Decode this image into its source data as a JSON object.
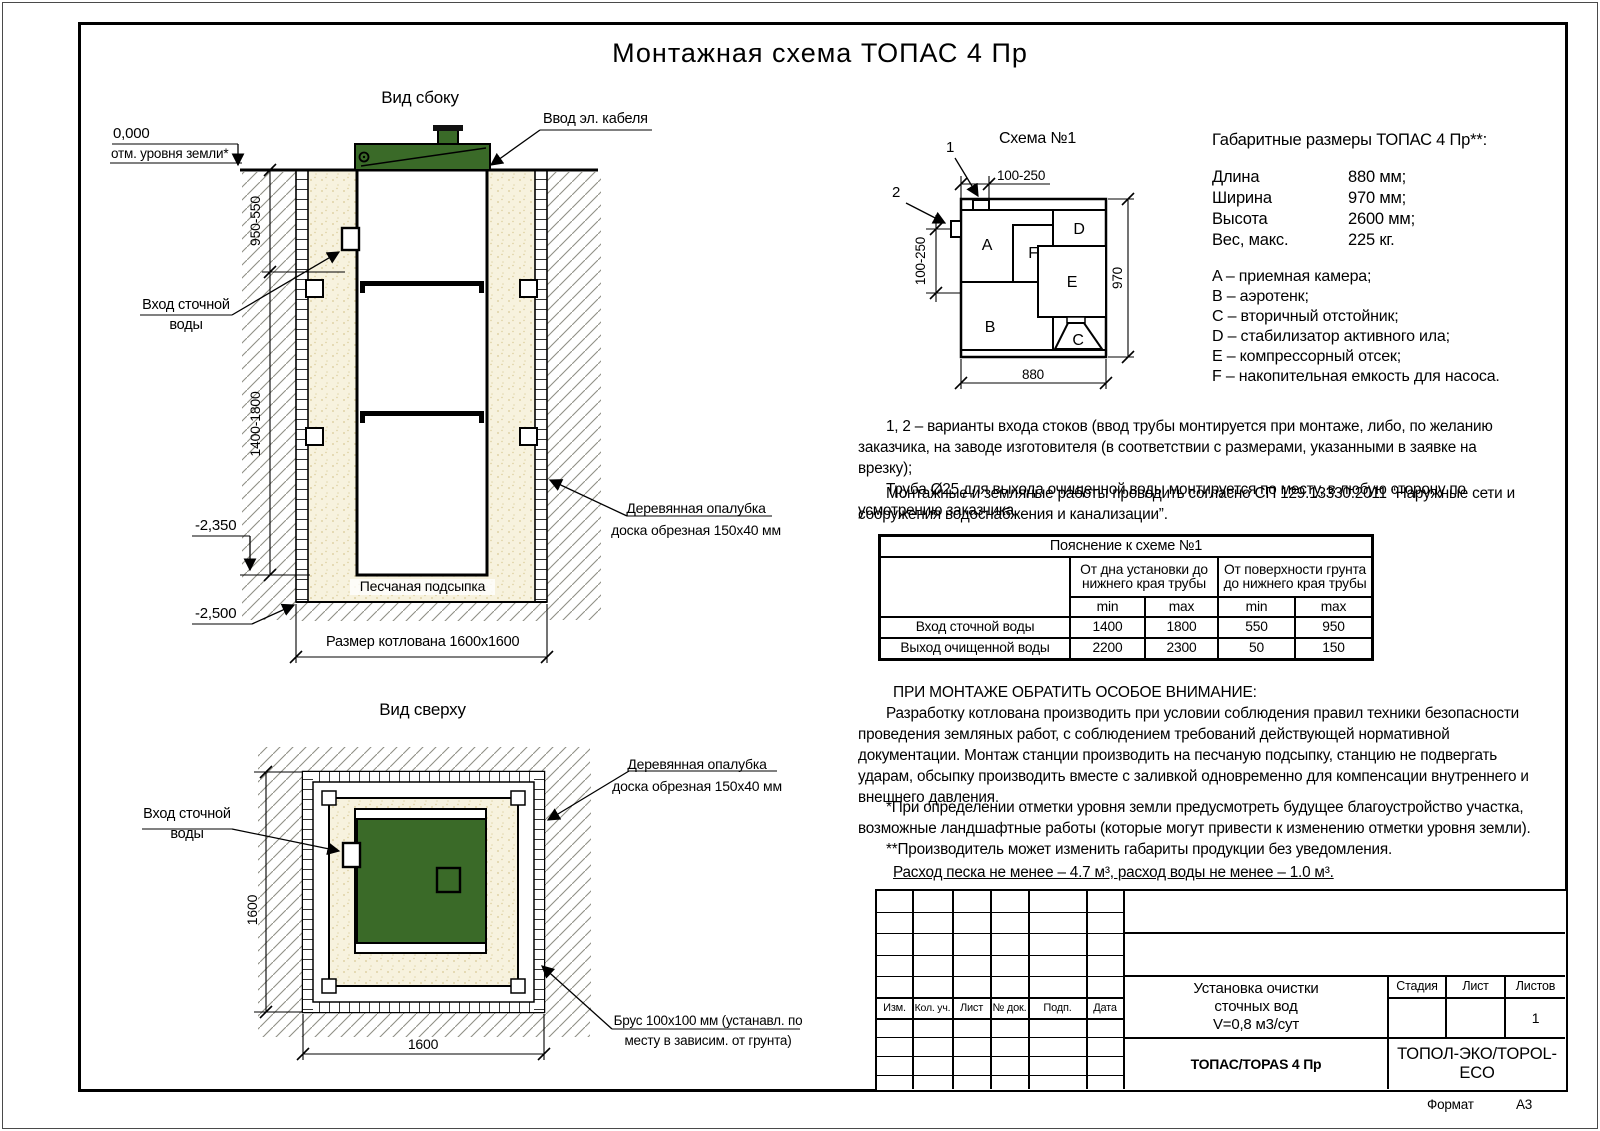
{
  "page": {
    "title": "Монтажная схема ТОПАС 4 Пр",
    "format_label": "Формат",
    "format_value": "А3"
  },
  "colors": {
    "lid_green": "#3a6a28",
    "sand": "#f7f2de",
    "line": "#000000",
    "hatch": "#8f8f85"
  },
  "side_view": {
    "title": "Вид сбоку",
    "cable_label": "Ввод эл. кабеля",
    "zero_mark": "0,000",
    "ground_mark": "отм. уровня земли*",
    "inlet_line1": "Вход сточной",
    "inlet_line2": "воды",
    "dim_upper": "950-550",
    "dim_lower": "1400-1800",
    "level1": "-2,350",
    "level2": "-2,500",
    "sand_label": "Песчаная подсыпка",
    "pit_dim": "Размер котлована 1600x1600",
    "formwork_line1": "Деревянная опалубка",
    "formwork_line2": "доска обрезная 150x40 мм"
  },
  "top_view": {
    "title": "Вид сверху",
    "inlet_line1": "Вход сточной",
    "inlet_line2": "воды",
    "formwork_line1": "Деревянная опалубка",
    "formwork_line2": "доска обрезная 150x40 мм",
    "dim_vertical": "1600",
    "dim_horizontal": "1600",
    "timber_line1": "Брус 100x100 мм (устанавл. по",
    "timber_line2": "месту в зависим. от грунта)"
  },
  "schema": {
    "title": "Схема №1",
    "marker1": "1",
    "marker2": "2",
    "dim_top": "100-250",
    "dim_left": "100-250",
    "dim_right": "970",
    "dim_bottom": "880",
    "compartments": {
      "a": "A",
      "b": "B",
      "c": "C",
      "d": "D",
      "e": "E",
      "f": "F"
    }
  },
  "specs": {
    "heading": "Габаритные размеры ТОПАС 4 Пр**:",
    "rows": [
      {
        "label": "Длина",
        "value": "880 мм;"
      },
      {
        "label": "Ширина",
        "value": "970 мм;"
      },
      {
        "label": "Высота",
        "value": "2600 мм;"
      },
      {
        "label": "Вес, макс.",
        "value": "225 кг."
      }
    ],
    "legend": [
      "A – приемная камера;",
      "B – аэротенк;",
      "C – вторичный отстойник;",
      "D – стабилизатор активного ила;",
      "E – компрессорный отсек;",
      "F – накопительная емкость для насоса."
    ]
  },
  "notes": {
    "p1": "1, 2 – варианты входа  стоков (ввод трубы монтируется при монтаже, либо, по желанию заказчика, на заводе изготовителя (в соответствии с размерами, указанными в заявке на врезку);",
    "p2": "Труба Ø25 для выхода очищенной воды монтируется по месту, в любую сторону по усмотрению заказчика.",
    "p3": "Монтажные и земляные работы проводить согласно СП 129.13330.2011 “Наружные сети и сооружения водоснабжения и канализации”."
  },
  "table": {
    "title": "Пояснение к схеме №1",
    "group1": "От дна установки до нижнего края трубы",
    "group2": "От поверхности грунта до нижнего края трубы",
    "min": "min",
    "max": "max",
    "rows": [
      {
        "label": "Вход сточной воды",
        "values": [
          "1400",
          "1800",
          "550",
          "950"
        ]
      },
      {
        "label": "Выход очищенной воды",
        "values": [
          "2200",
          "2300",
          "50",
          "150"
        ]
      }
    ]
  },
  "attention": {
    "heading": "ПРИ МОНТАЖЕ ОБРАТИТЬ ОСОБОЕ ВНИМАНИЕ:",
    "body": "Разработку котлована производить при условии соблюдения правил техники безопасности проведения земляных работ, с соблюдением требований действующей нормативной документации. Монтаж станции производить на песчаную подсыпку, станцию не подвергать ударам, обсыпку производить вместе с заливкой одновременно для компенсации внутреннего и внешнего давления.",
    "footnote1": "*При определении отметки уровня земли предусмотреть будущее благоустройство участка, возможные ландшафтные работы (которые могут привести к изменению отметки уровня земли).",
    "footnote2": "**Производитель может изменить габариты продукции без уведомления.",
    "consumption": "Расход песка не менее – 4.7 м³, расход воды не менее – 1.0 м³."
  },
  "titleblock": {
    "columns": [
      "Изм.",
      "Кол. уч.",
      "Лист",
      "№ док.",
      "Подп.",
      "Дата"
    ],
    "project_line1": "Установка очистки",
    "project_line2": "сточных вод",
    "project_line3": "V=0,8 м3/сут",
    "stage_label": "Стадия",
    "sheet_label": "Лист",
    "sheets_label": "Листов",
    "sheets_value": "1",
    "model": "ТОПАС/TOPAS 4 Пр",
    "company": "ТОПОЛ-ЭКО/TOPOL-ECO"
  }
}
